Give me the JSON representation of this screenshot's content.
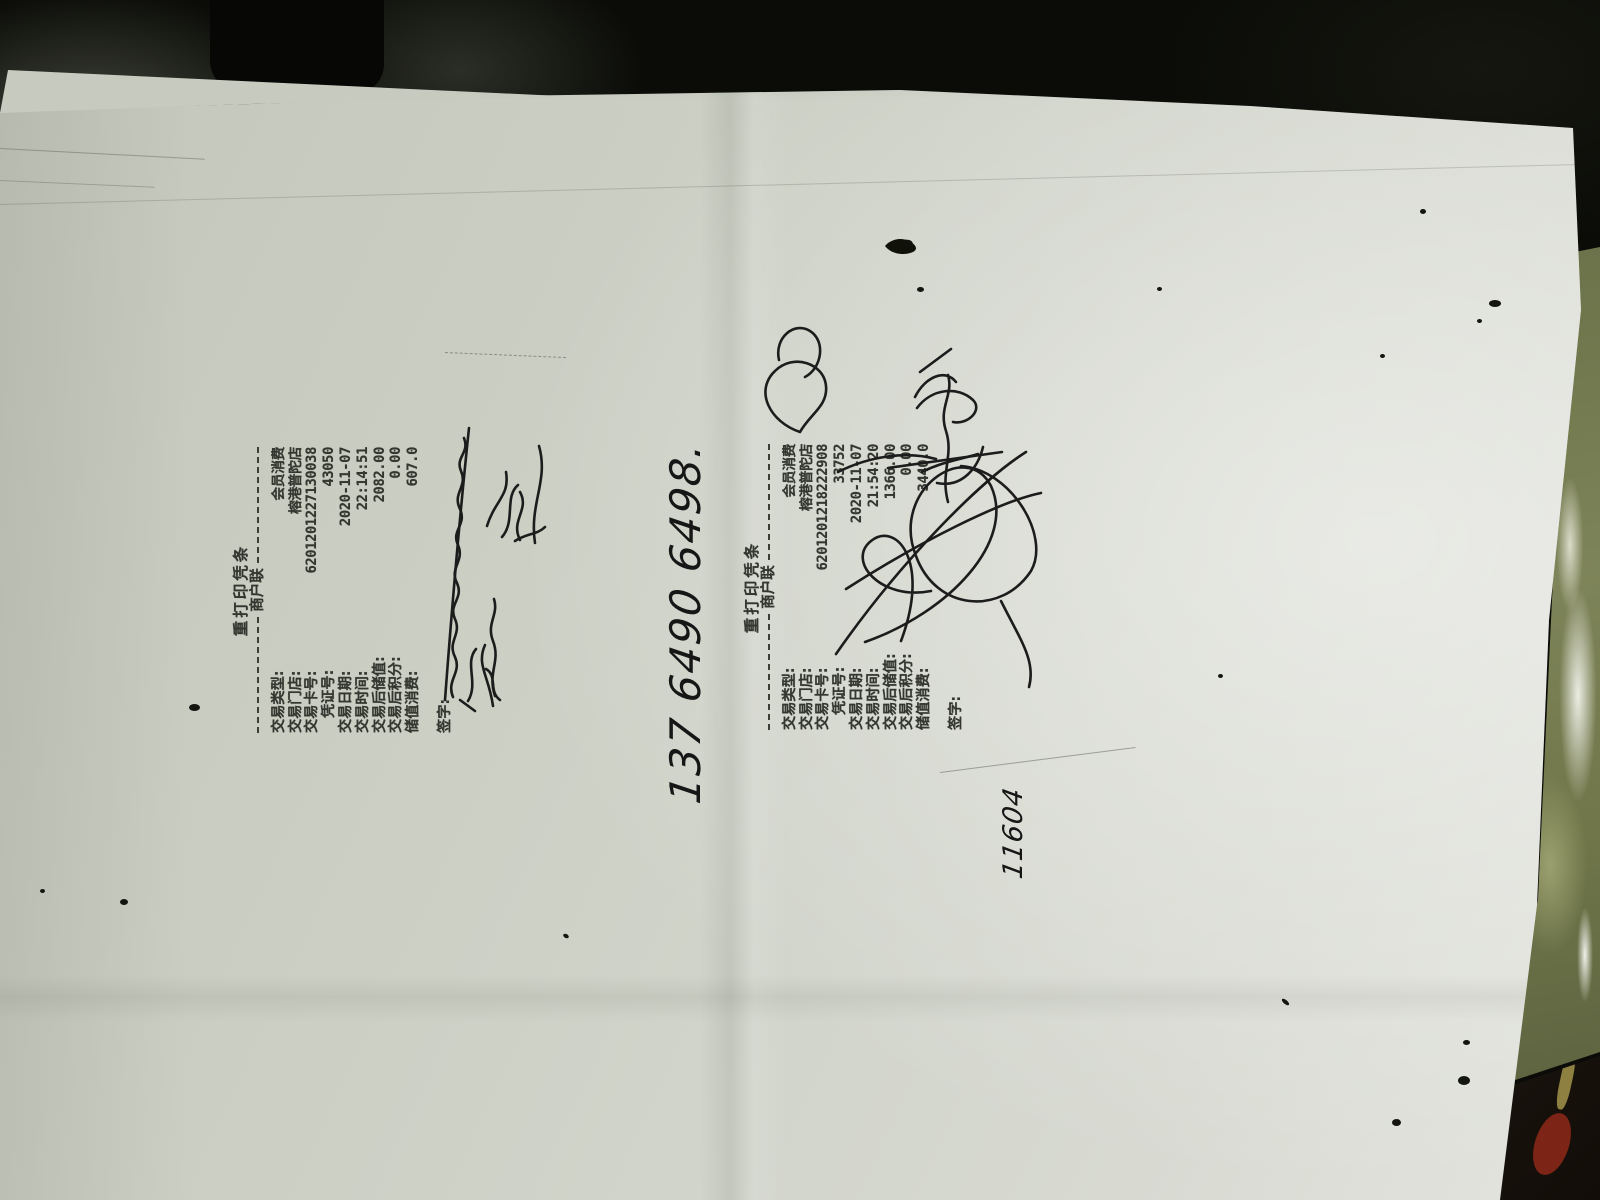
{
  "receipts": [
    {
      "title": "重打印凭条",
      "copy_label": "商户联",
      "rows": [
        {
          "label": "交易类型:",
          "value": "会员消费"
        },
        {
          "label": "交易门店:",
          "value": "榕港普陀店"
        },
        {
          "label": "交易卡号:",
          "value": "6201201227130038"
        },
        {
          "label": "凭证号:",
          "value": "43050"
        },
        {
          "label": "交易日期:",
          "value": "2020-11-07"
        },
        {
          "label": "交易时间:",
          "value": "22:14:51"
        },
        {
          "label": "交易后储值:",
          "value": "2082.00"
        },
        {
          "label": "交易后积分:",
          "value": "0.00"
        },
        {
          "label": "储值消费:",
          "value": "607.0"
        }
      ],
      "signature_label": "签字:"
    },
    {
      "title": "重打印凭条",
      "copy_label": "商户联",
      "rows": [
        {
          "label": "交易类型:",
          "value": "会员消费"
        },
        {
          "label": "交易门店:",
          "value": "榕港普陀店"
        },
        {
          "label": "交易卡号:",
          "value": "6201201218222908"
        },
        {
          "label": "凭证号:",
          "value": "33752"
        },
        {
          "label": "交易日期:",
          "value": "2020-11-07"
        },
        {
          "label": "交易时间:",
          "value": "21:54:20"
        },
        {
          "label": "交易后储值:",
          "value": "1366.00"
        },
        {
          "label": "交易后积分:",
          "value": "0.00"
        },
        {
          "label": "储值消费:",
          "value": "3440.0"
        }
      ],
      "signature_label": "签字:"
    }
  ],
  "handwriting": {
    "phone_number": "137 6490 6498.",
    "number_note": "11604"
  },
  "colors": {
    "paper": "#ced2c8",
    "print_ink": "#34372f",
    "pen_ink": "#1c1c1c",
    "background": "#0c0d09",
    "marble_surface": "#767c4f",
    "red_object": "#7c2415"
  }
}
